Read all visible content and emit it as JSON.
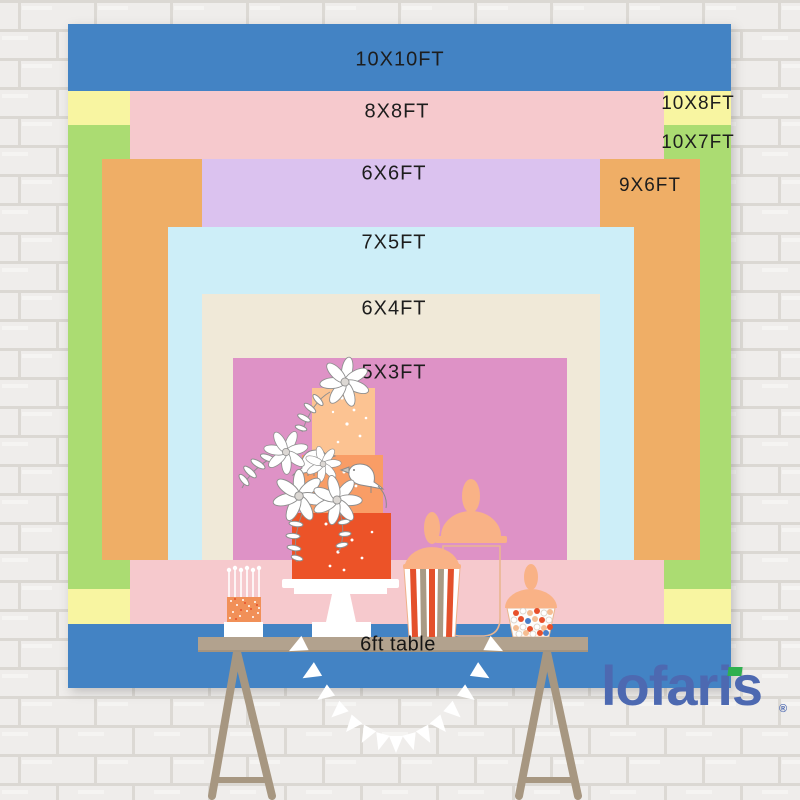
{
  "title": "Backdrop size comparison chart",
  "sizes": [
    {
      "label": "10X10FT",
      "width_ft": 10,
      "height_ft": 10,
      "color": "#4383c4"
    },
    {
      "label": "10X8FT",
      "width_ft": 10,
      "height_ft": 8,
      "color": "#f8f5a1"
    },
    {
      "label": "10X7FT",
      "width_ft": 10,
      "height_ft": 7,
      "color": "#abdc72"
    },
    {
      "label": "8X8FT",
      "width_ft": 8,
      "height_ft": 8,
      "color": "#f6c9cd"
    },
    {
      "label": "9X6FT",
      "width_ft": 9,
      "height_ft": 6,
      "color": "#efae66"
    },
    {
      "label": "6X6FT",
      "width_ft": 6,
      "height_ft": 6,
      "color": "#dbc2ef"
    },
    {
      "label": "7X5FT",
      "width_ft": 7,
      "height_ft": 5,
      "color": "#cdeef8"
    },
    {
      "label": "6X4FT",
      "width_ft": 6,
      "height_ft": 4,
      "color": "#f0e9d8"
    },
    {
      "label": "5X3FT",
      "width_ft": 5,
      "height_ft": 3,
      "color": "#de92c6"
    }
  ],
  "table": {
    "label": "6ft table"
  },
  "brand": {
    "logo_text": "lofaris",
    "registered_mark": "®",
    "logo_color": "#4d69b1",
    "accent_green": "#2fb050"
  },
  "decorations": [
    "tiered-cake-icon",
    "mini-birthday-cake-icon",
    "popcorn-jar-icon",
    "candy-jar-icon",
    "glass-jar-icon",
    "bunting-garland-icon",
    "trestle-table"
  ]
}
